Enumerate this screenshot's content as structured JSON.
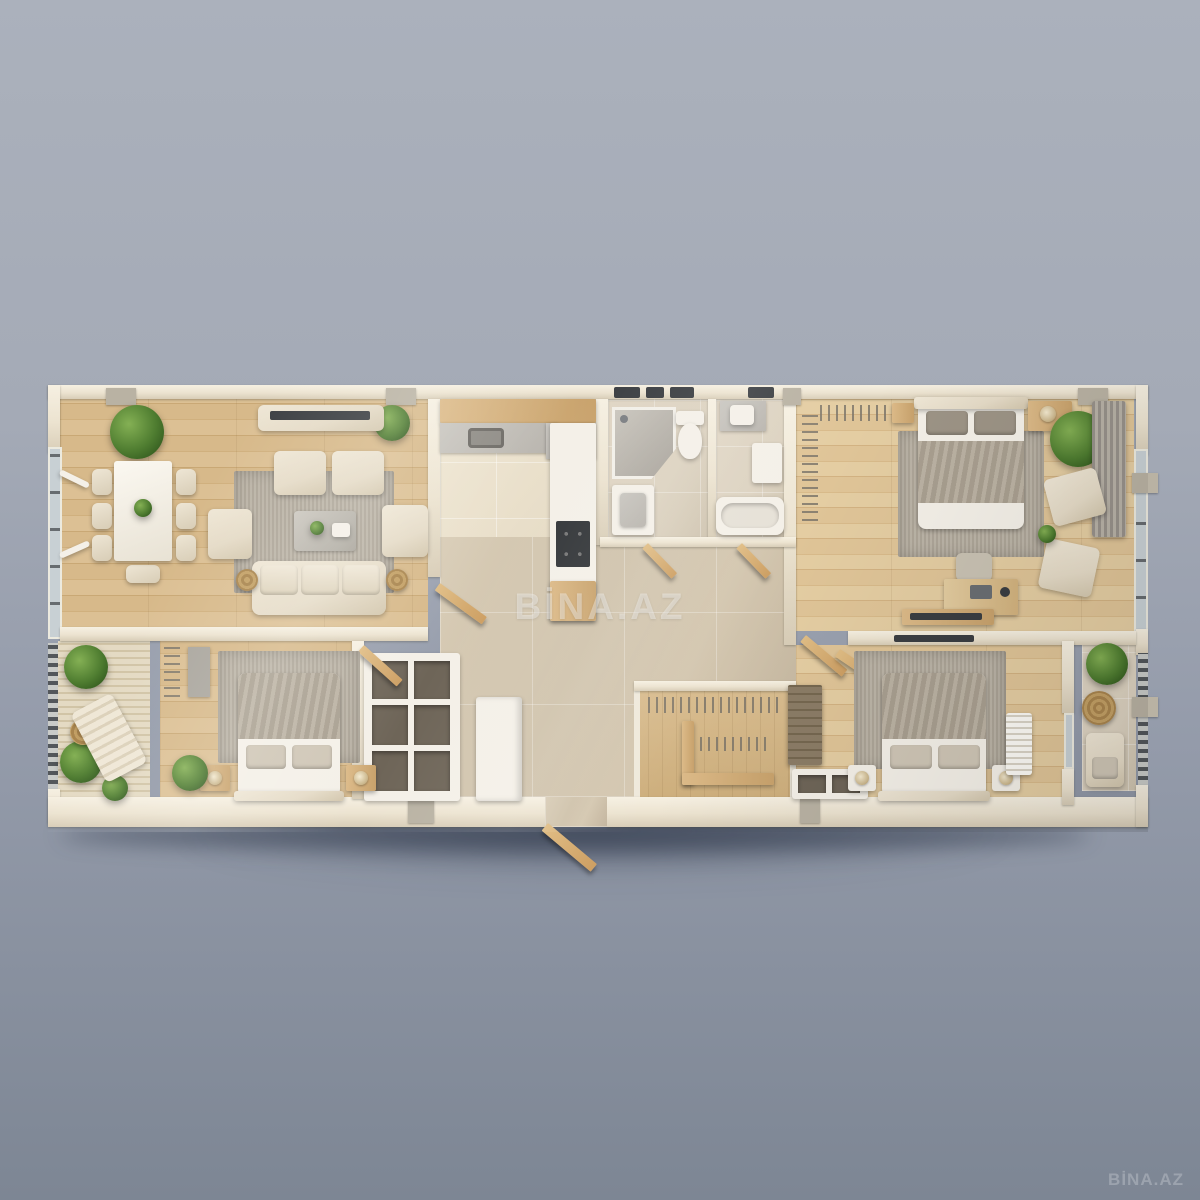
{
  "watermark": {
    "center_text": "BİNA.AZ",
    "corner_text": "BİNA.AZ"
  },
  "palette": {
    "background_top": "#abb1bc",
    "background_bottom": "#7d8694",
    "wall": "#ece3d0",
    "wall_light": "#f6f0e2",
    "wall_shade": "#d8cdb7",
    "stub": "#b9b2a3",
    "wood": "#d5b685",
    "wood_light": "#e0c89d",
    "tile_kitchen": "#e9dfca",
    "tile_bath": "#dcd2c0",
    "tile_hall": "#cfc2ab",
    "deck": "#e4dac3",
    "rug": "#b6aea0",
    "upholstery": "#e5dbc7",
    "blanket": "#b3a999",
    "dark": "#3b3e42",
    "plant": "#4e7c30",
    "door_wood": "#cd9f63",
    "counter": "#b8b4ad",
    "white": "#f4f0e8"
  }
}
